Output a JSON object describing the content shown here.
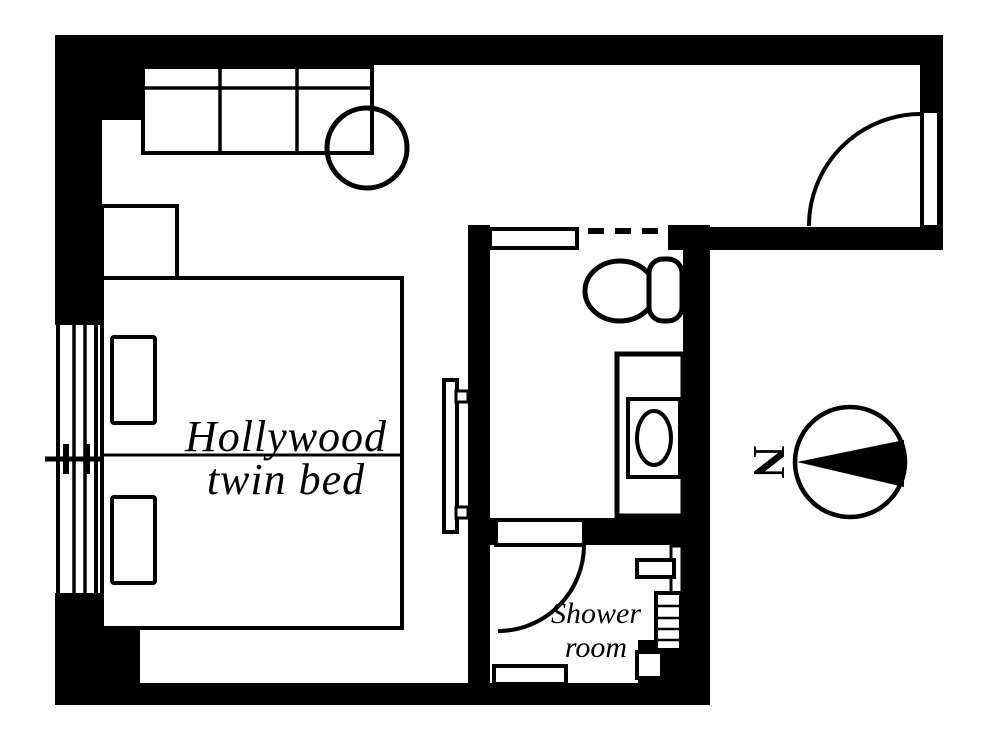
{
  "canvas": {
    "width": 1000,
    "height": 750,
    "background_color": "#ffffff",
    "ink_color": "#000000"
  },
  "plan": {
    "type": "hotel-room-floor-plan",
    "labels": {
      "bed_label_line1": "Hollywood",
      "bed_label_line2": "twin bed",
      "shower_label_line1": "Shower",
      "shower_label_line2": "room",
      "compass_north_letter": "N"
    },
    "furniture_icons": [
      "sofa-icon",
      "round-table-icon",
      "window-icon",
      "nightstand-icon",
      "twin-bed-icon",
      "pillow-icon",
      "wall-tv-icon",
      "entrance-door-swing-icon",
      "sliding-door-icon",
      "dashed-opening-icon",
      "toilet-icon",
      "vanity-sink-icon",
      "shower-door-swing-icon",
      "shower-shelf-icon",
      "shower-control-panel-icon",
      "shower-bench-icon",
      "compass-north-icon"
    ]
  }
}
